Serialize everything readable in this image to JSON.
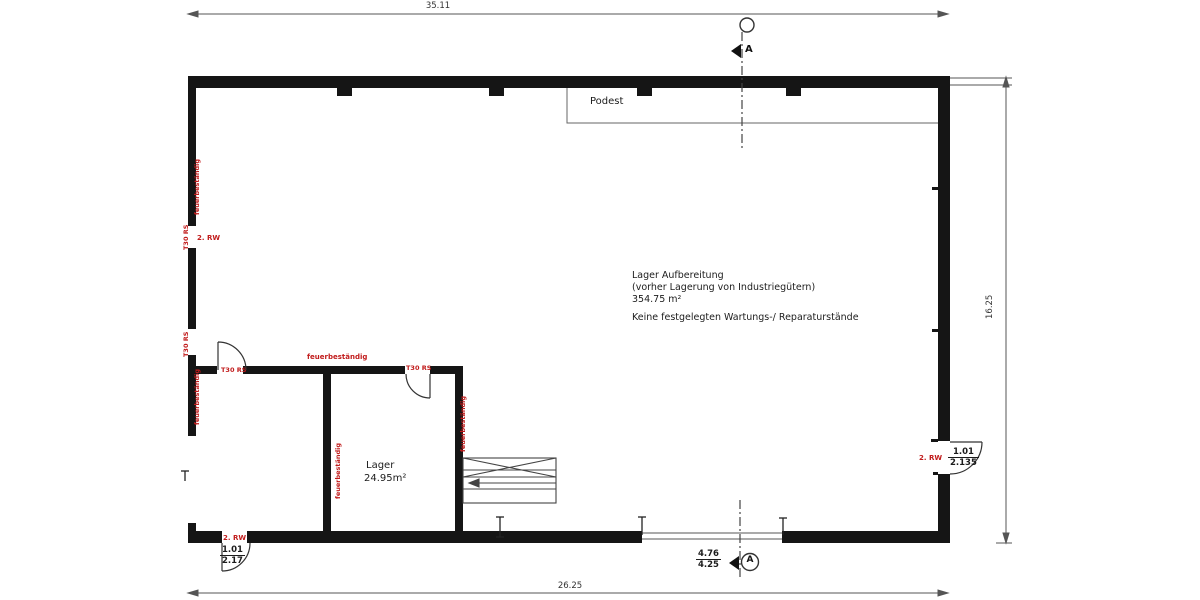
{
  "plan": {
    "title": "Floor plan - Lager Aufbereitung",
    "dim_top": "35.11",
    "dim_bottom": "26.25",
    "dim_right": "16.25",
    "podest": "Podest",
    "section_label": "A",
    "hall": {
      "l1": "Lager Aufbereitung",
      "l2": "(vorher Lagerung von Industriegütern)",
      "l3": "354.75 m²",
      "l4": "Keine festgelegten Wartungs-/ Reparaturstände"
    },
    "lager": {
      "name": "Lager",
      "area": "24.95m²"
    },
    "red": {
      "fire": "feuerbeständig",
      "t30": "T30 RS",
      "rw": "2. RW"
    },
    "frac_bottom_left": {
      "num": "1.01",
      "den": "2.17"
    },
    "frac_right": {
      "num": "1.01",
      "den": "2.135"
    },
    "frac_gate": {
      "num": "4.76",
      "den": "4.25"
    },
    "colors": {
      "wall": "#151515",
      "annotation_red": "#c11b1b",
      "thin_line": "#555555"
    }
  }
}
